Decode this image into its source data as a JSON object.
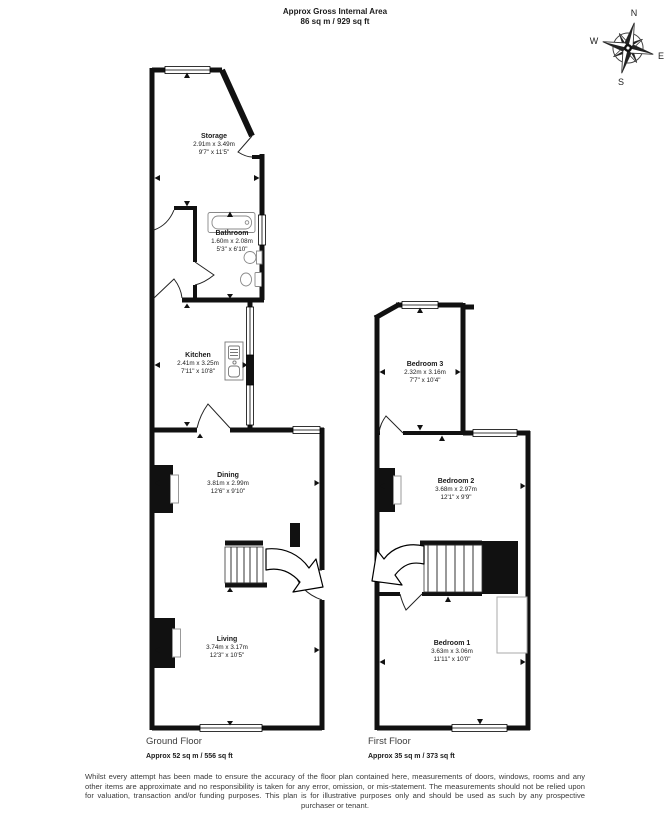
{
  "header": {
    "line1": "Approx Gross Internal Area",
    "line2": "86 sq m / 929 sq ft"
  },
  "compass": {
    "n": "N",
    "e": "E",
    "s": "S",
    "w": "W"
  },
  "floors": [
    {
      "name": "Ground Floor",
      "area": "Approx 52 sq m / 556 sq ft",
      "rooms": [
        {
          "name": "Storage",
          "metric": "2.91m x 3.49m",
          "imperial": "9'7\" x 11'5\""
        },
        {
          "name": "Bathroom",
          "metric": "1.60m x 2.08m",
          "imperial": "5'3\" x 6'10\""
        },
        {
          "name": "Kitchen",
          "metric": "2.41m x 3.25m",
          "imperial": "7'11\" x 10'8\""
        },
        {
          "name": "Dining",
          "metric": "3.81m x 2.99m",
          "imperial": "12'6\" x 9'10\""
        },
        {
          "name": "Living",
          "metric": "3.74m x 3.17m",
          "imperial": "12'3\" x 10'5\""
        }
      ]
    },
    {
      "name": "First Floor",
      "area": "Approx 35 sq m / 373 sq ft",
      "rooms": [
        {
          "name": "Bedroom 3",
          "metric": "2.32m x 3.16m",
          "imperial": "7'7\" x 10'4\""
        },
        {
          "name": "Bedroom 2",
          "metric": "3.68m x 2.97m",
          "imperial": "12'1\" x 9'9\""
        },
        {
          "name": "Bedroom 1",
          "metric": "3.63m x 3.06m",
          "imperial": "11'11\" x 10'0\""
        }
      ]
    }
  ],
  "disclaimer": "Whilst every attempt has been made to ensure the accuracy of the floor plan contained here, measurements of doors, windows, rooms and any other items are approximate and no responsibility is taken for any error, omission, or mis-statement. The measurements should not be relied upon for valuation, transaction and/or funding purposes. This plan is for illustrative purposes only and should be used as such by any prospective purchaser or tenant."
}
